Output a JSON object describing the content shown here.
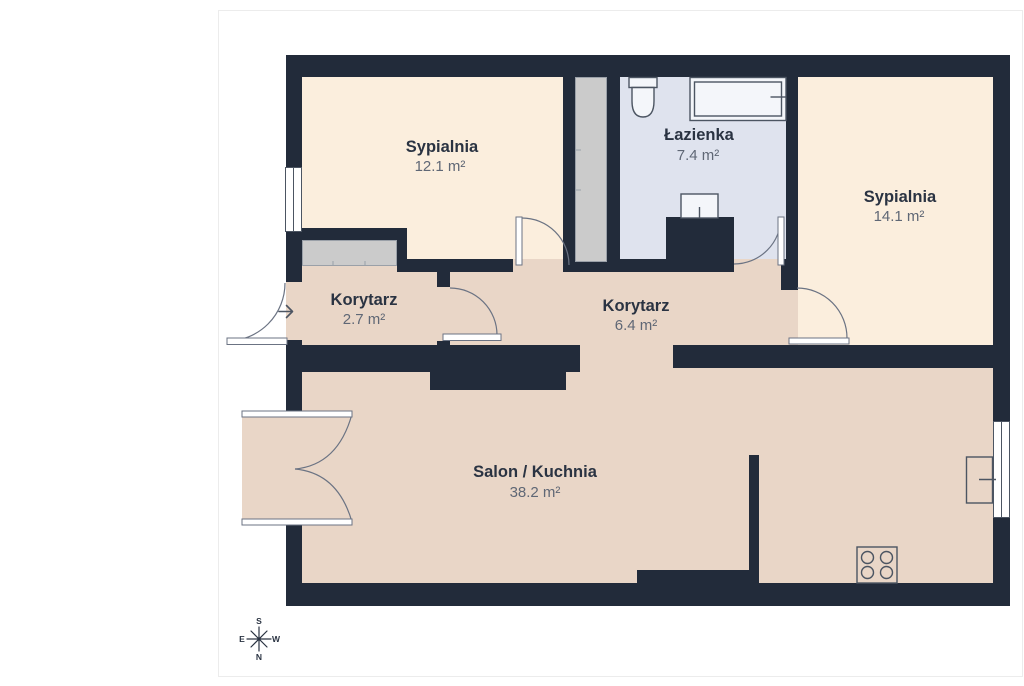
{
  "floor_plan": {
    "rooms": [
      {
        "name": "Sypialnia",
        "area": "12.1 m²"
      },
      {
        "name": "Łazienka",
        "area": "7.4 m²"
      },
      {
        "name": "Sypialnia",
        "area": "14.1 m²"
      },
      {
        "name": "Korytarz",
        "area": "2.7 m²"
      },
      {
        "name": "Korytarz",
        "area": "6.4 m²"
      },
      {
        "name": "Salon / Kuchnia",
        "area": "38.2 m²"
      }
    ],
    "compass": {
      "top": "S",
      "bottom": "N",
      "left": "E",
      "right": "W"
    },
    "colors": {
      "wall": "#222b3a",
      "cream": "#fbeedd",
      "blue": "#dfe3ee",
      "pink": "#e9d6c7",
      "ward": "#cbcbcb",
      "ward_border": "#9aa0a8",
      "line": "#6b7383",
      "fixture": "#4c5562",
      "fixture_fill": "#f4f6fa",
      "text_dark": "#2a3342",
      "text_gray": "#5f6775",
      "frame": "#ececec"
    }
  }
}
